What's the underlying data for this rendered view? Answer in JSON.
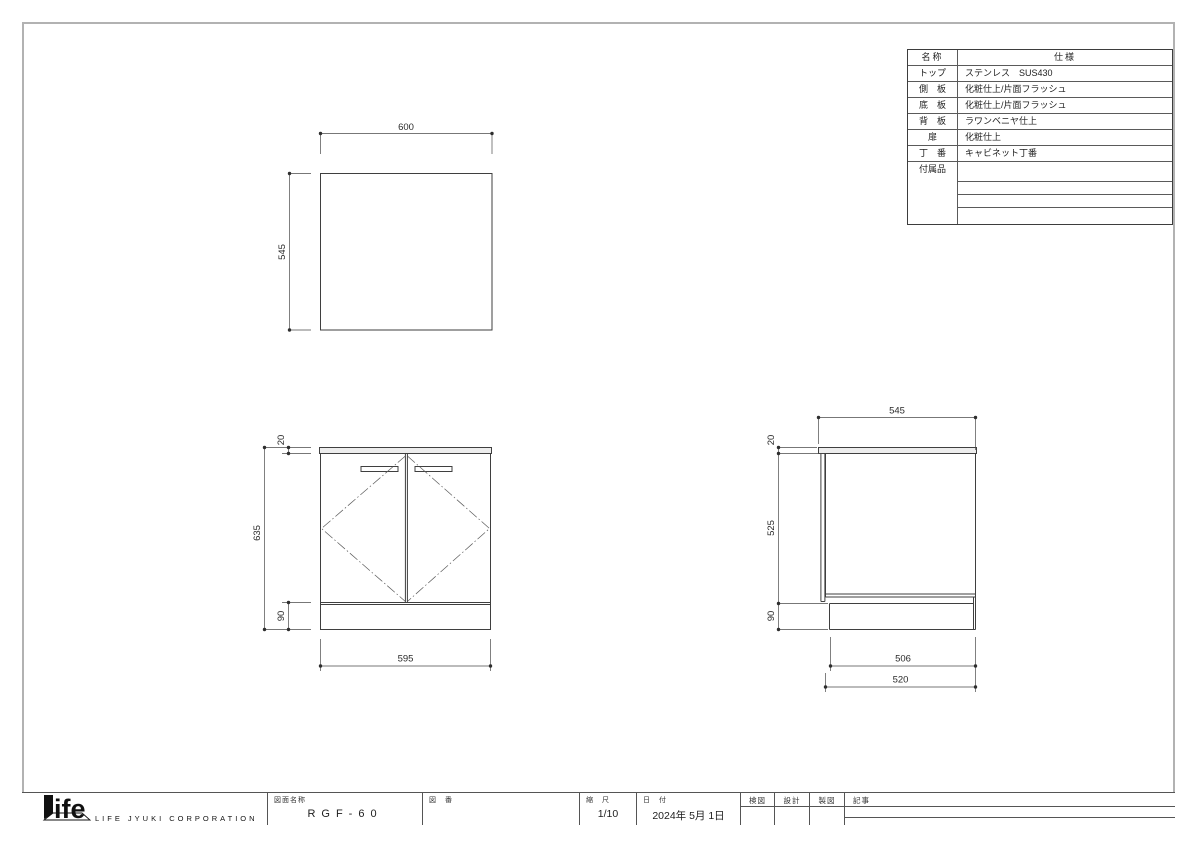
{
  "page": {
    "border_color": "#b2b2b2"
  },
  "spec_table": {
    "header": {
      "name_col": "名称",
      "spec_col": "仕様"
    },
    "rows": [
      {
        "label": "トップ",
        "value": "ステンレス　SUS430"
      },
      {
        "label": "側　板",
        "value": "化粧仕上/片面フラッシュ"
      },
      {
        "label": "底　板",
        "value": "化粧仕上/片面フラッシュ"
      },
      {
        "label": "背　板",
        "value": "ラワンベニヤ仕上"
      },
      {
        "label": "扉",
        "value": "化粧仕上"
      },
      {
        "label": "丁　番",
        "value": "キャビネット丁番"
      },
      {
        "label": "付属品",
        "value": ""
      }
    ]
  },
  "dimensions": {
    "top_view": {
      "width": "600",
      "depth": "545"
    },
    "front_view": {
      "counter_height": "20",
      "body_height": "635",
      "kick_height": "90",
      "body_width": "595"
    },
    "side_view": {
      "depth": "545",
      "counter_height": "20",
      "body_height": "525",
      "kick_height": "90",
      "kick_depth": "506",
      "base_depth": "520"
    }
  },
  "title_block": {
    "logo_text": "ife",
    "company": "LIFE JYUKI CORPORATION",
    "drawing_name_label": "図面名称",
    "drawing_name": "RGF-60",
    "drawing_no_label": "図　番",
    "drawing_no": "",
    "scale_label": "縮　尺",
    "scale": "1/10",
    "date_label": "日　付",
    "date": "2024年 5月 1日",
    "check_label": "検図",
    "design_label": "設計",
    "draft_label": "製図",
    "notes_label": "記事"
  }
}
